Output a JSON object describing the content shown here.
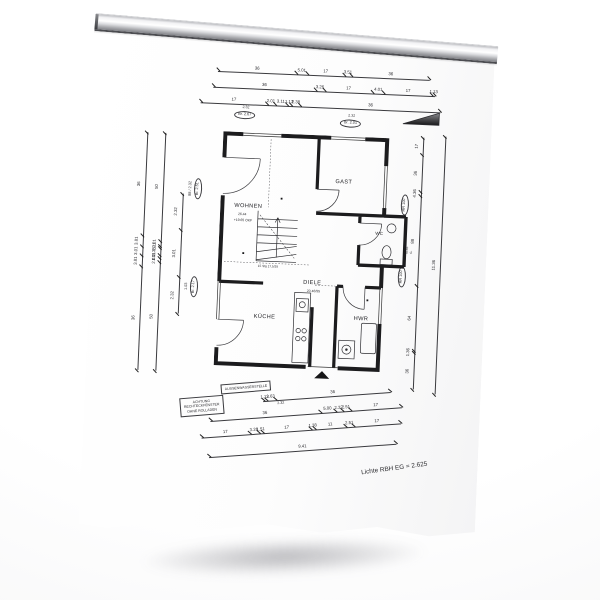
{
  "scene": {
    "type": "photo of architectural floor plan sheet on wall rail"
  },
  "drawing": {
    "rooms": {
      "wohnen": "WOHNEN",
      "wohnen_area": "26.44",
      "wohnen_level": "+19.65 OKF",
      "gast": "GAST",
      "diele": "DIELE",
      "diele_note": "20 46/55",
      "kueche": "KÜCHE",
      "hwr": "HWR",
      "wc": "WC",
      "wc_note": "Kl.AF G."
    },
    "stair_note": "15 Stg 17,5/29",
    "caption": "Lichte RBH EG = 2.625",
    "notes": {
      "warning": [
        "ACHTUNG",
        "RECHTECKFENSTER",
        "OHNE ROLLADEN"
      ],
      "outdoor_tap": "AUSSENWASSERSTELLE"
    },
    "dims": {
      "top": [
        [
          "36",
          "5.01",
          "17",
          "3.51",
          "36"
        ],
        [
          "36",
          "3.26",
          "17",
          "4.01",
          "17",
          "1.13"
        ],
        [
          "17",
          "2.01",
          "3.11",
          "1.13",
          "2.38",
          "36"
        ]
      ],
      "top_tags": [
        {
          "size": "2.32",
          "oval": "Br. 2.67"
        },
        {
          "size": "2.32",
          "oval": "Br. 2.01"
        }
      ],
      "left": [
        [
          "36",
          "3.81",
          "3.01",
          "3.81",
          "36"
        ],
        [
          "50",
          "2.01",
          "1.11",
          "3.38",
          "1.11",
          "2.01",
          "50"
        ],
        [
          "2.32",
          "3.01",
          "2.32"
        ]
      ],
      "left_tags": [
        {
          "size": "88 / 2.32",
          "oval": "Br. 2.51"
        },
        {
          "size": "1.03",
          "oval": "Br. 2.17"
        }
      ],
      "right": [
        [
          "17",
          "36",
          "4.36",
          "88",
          "64",
          "1.36",
          "36"
        ],
        [
          "11.36"
        ]
      ],
      "right_tags": [
        "RR 100",
        "RR 100"
      ],
      "bottom": [
        [
          "1.13",
          "2.63",
          "36"
        ],
        [
          "36",
          "5.00",
          "2.32",
          "2.51",
          "17"
        ],
        [
          "17",
          "3.26",
          "1.51",
          "17",
          "1.38",
          "11",
          "2.51",
          "17"
        ],
        [
          "9.41"
        ]
      ],
      "bottom_tag": "2.32"
    }
  }
}
